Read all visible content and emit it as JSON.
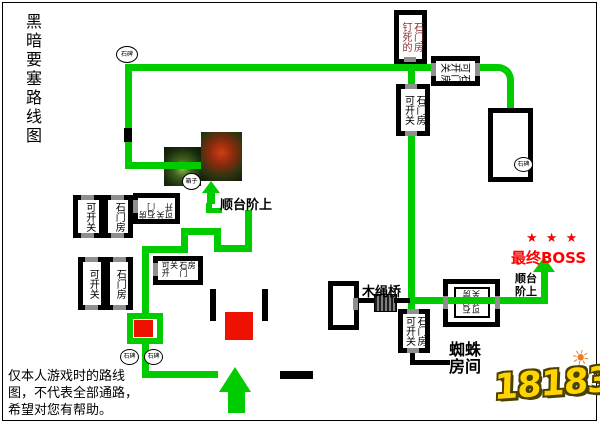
{
  "title": "黑暗要塞路线图",
  "note": [
    "仅本人游戏时的路线",
    "图，不代表全部通路，",
    "希望对您有帮助。"
  ],
  "rooms": {
    "nailed_col1": "钉死的",
    "nailed_col2": "石门房",
    "switch_col1": "可开关",
    "switch_col2": "石门房"
  },
  "markers": {
    "stone_tablet": "石碑",
    "chest": "箱子"
  },
  "labels": {
    "stairs_up": "顺台阶上",
    "stairs_up_line1": "顺台",
    "stairs_up_line2": "阶上",
    "wood_rope_bridge": "木绳桥",
    "spider_line1": "蜘蛛",
    "spider_line2": "房间",
    "final_boss": "最终BOSS",
    "boss_stars": "★ ★ ★"
  },
  "logo": {
    "site": "18183"
  },
  "icons": {
    "sun": "☀"
  },
  "colors": {
    "route_green": "#00cc00",
    "marker_red": "#ee1100",
    "boss_red": "#ff0000",
    "nailed_text": "#8b2f2f"
  }
}
